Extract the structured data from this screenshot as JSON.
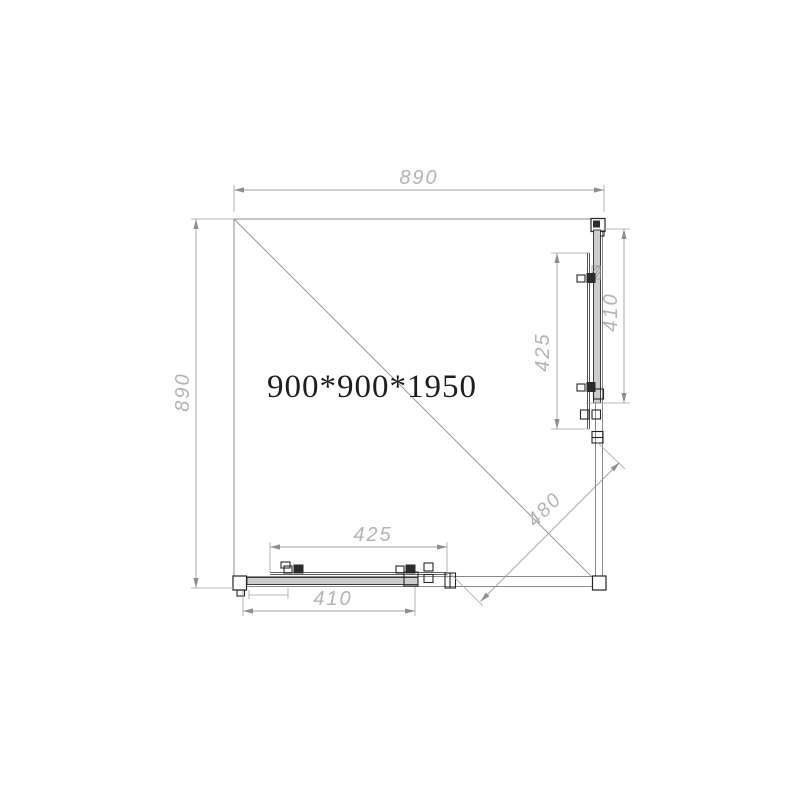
{
  "drawing": {
    "model_label": "900*900*1950",
    "dimensions": {
      "top_width": "890",
      "left_height": "890",
      "right_fixed_panel": "425",
      "right_door_panel": "410",
      "bottom_fixed_panel": "425",
      "bottom_door_panel": "410",
      "corner_opening_diagonal": "480"
    },
    "colors": {
      "background": "#ffffff",
      "outline_gray": "#8c8c8c",
      "dimension_line_gray": "#9f9f9f",
      "dimension_text_gray": "#b4b4b4",
      "detail_dark": "#262626",
      "model_text": "#1e1e1e",
      "glass_fill": "#cdcdcd"
    }
  }
}
